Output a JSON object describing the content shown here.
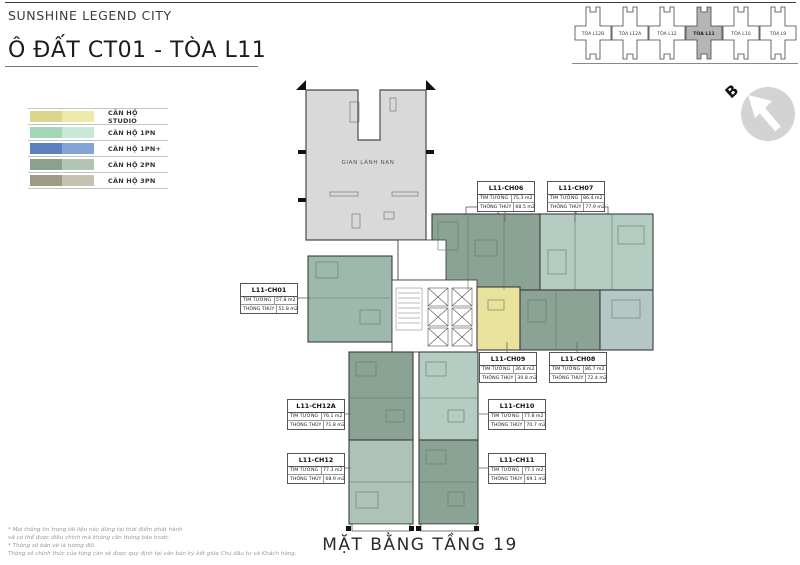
{
  "header": {
    "brand": "SUNSHINE LEGEND CITY",
    "title": "Ô ĐẤT CT01 - TÒA L11"
  },
  "tower_map": {
    "towers": [
      {
        "label": "TÒA L12B",
        "fill": "#ffffff"
      },
      {
        "label": "TÒA L12A",
        "fill": "#ffffff"
      },
      {
        "label": "TÒA L12",
        "fill": "#ffffff"
      },
      {
        "label": "TÒA L11",
        "fill": "#b5b5b5"
      },
      {
        "label": "TÒA L10",
        "fill": "#ffffff"
      },
      {
        "label": "TÒA L9",
        "fill": "#ffffff"
      }
    ]
  },
  "compass": {
    "north_label": "B"
  },
  "legend": {
    "items": [
      {
        "label": "CĂN HỘ STUDIO",
        "color_dark": "#dbd58d",
        "color_light": "#efeaa9"
      },
      {
        "label": "CĂN HỘ 1PN",
        "color_dark": "#a2d8b9",
        "color_light": "#c8e9d6"
      },
      {
        "label": "CĂN HỘ 1PN+",
        "color_dark": "#5d80c1",
        "color_light": "#84a3d6"
      },
      {
        "label": "CĂN HỘ 2PN",
        "color_dark": "#8ba08d",
        "color_light": "#b2c4b3"
      },
      {
        "label": "CĂN HỘ 3PN",
        "color_dark": "#9f9b87",
        "color_light": "#c5c2b1"
      }
    ]
  },
  "plan": {
    "refuge_label": "GIAN LÁNH NẠN",
    "refuge_fill": "#d9d9d9",
    "dim_label_tim": "TIM TƯỜNG",
    "dim_label_thong": "THÔNG THỦY",
    "units": [
      {
        "id": "L11-CH01",
        "tim": "57.8 m2",
        "thong": "51.8 m2",
        "fill": "#9db9ab"
      },
      {
        "id": "L11-CH06",
        "tim": "75.3 m2",
        "thong": "68.5 m2",
        "fill": "#8ba394"
      },
      {
        "id": "L11-CH07",
        "tim": "86.4 m2",
        "thong": "77.9 m2",
        "fill": "#b4ccc2"
      },
      {
        "id": "L11-CH08",
        "tim": "86.7 m2",
        "thong": "72.4 m2",
        "fill": "#8ba394",
        "fill_alt": "#b4c7c4"
      },
      {
        "id": "L11-CH09",
        "tim": "36.8 m2",
        "thong": "30.8 m2",
        "fill": "#e8e29d"
      },
      {
        "id": "L11-CH10",
        "tim": "77.8 m2",
        "thong": "70.7 m2",
        "fill": "#b4ccc2"
      },
      {
        "id": "L11-CH11",
        "tim": "77.1 m2",
        "thong": "69.1 m2",
        "fill": "#8ba394"
      },
      {
        "id": "L11-CH12A",
        "tim": "76.1 m2",
        "thong": "71.8 m2",
        "fill": "#8ba394"
      },
      {
        "id": "L11-CH12",
        "tim": "77.3 m2",
        "thong": "68.9 m2",
        "fill": "#aec3b8"
      }
    ]
  },
  "footer": {
    "floor_title": "MẶT BẰNG TẦNG 19",
    "disclaimer": [
      "* Mọi thông tin trong tài liệu này đúng tại thời điểm phát hành",
      "và có thể được điều chỉnh mà không cần thông báo trước.",
      "* Thông số bản vẽ là tương đối.",
      "Thông số chính thức của từng căn sẽ được quy định tại văn bản ký kết giữa Chủ đầu tư và Khách hàng."
    ]
  }
}
